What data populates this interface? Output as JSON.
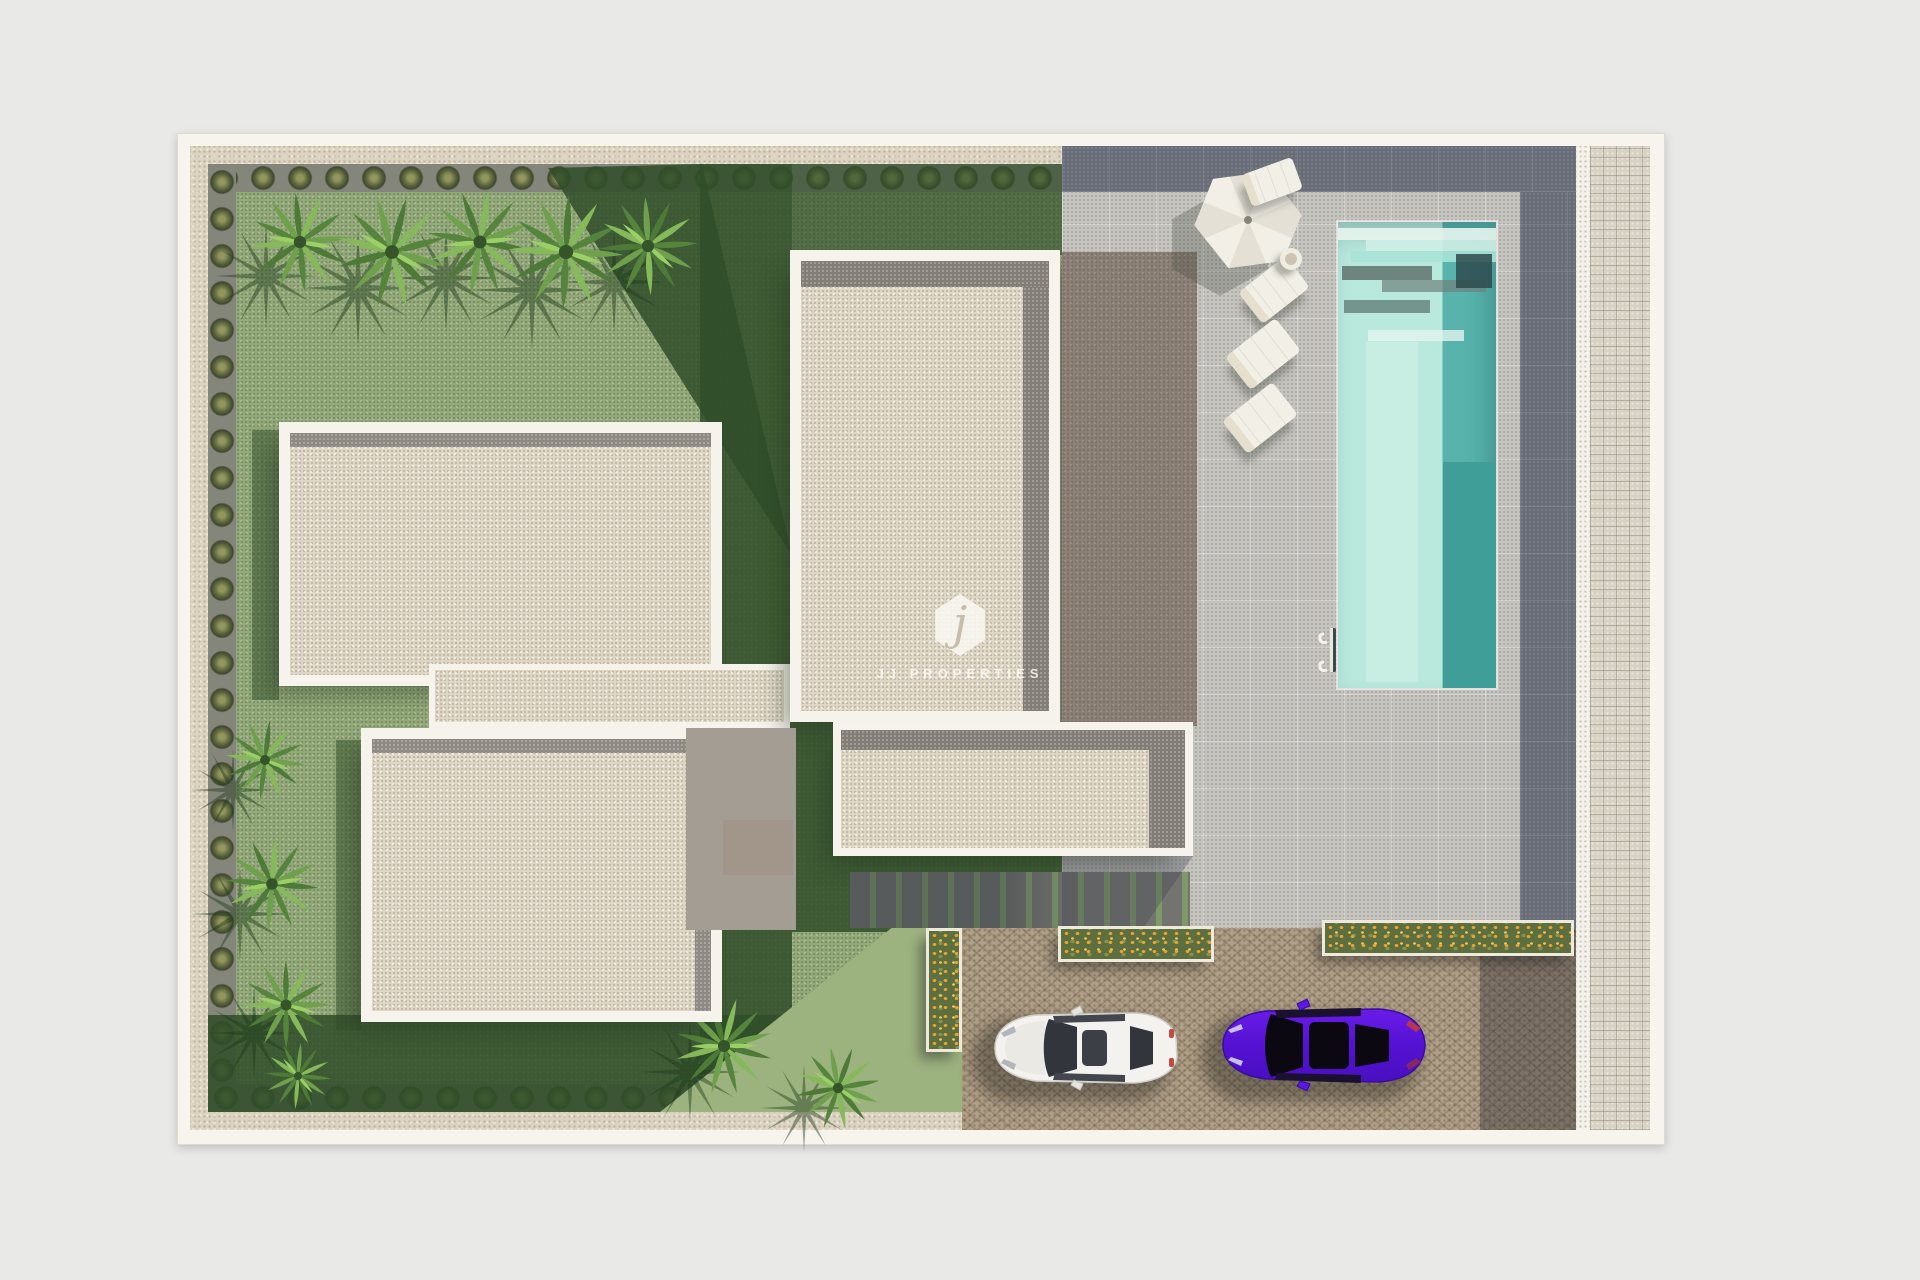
{
  "watermark": {
    "logo_letter": "j",
    "brand": "JJ PROPERTIES"
  },
  "scene": {
    "description": "Top-down 3D architectural render of a villa plot",
    "elements": [
      "garden lawn",
      "palm trees",
      "perimeter hedge",
      "villa flat roofs",
      "swimming pool",
      "pool ladder",
      "sun umbrella",
      "sun loungers",
      "side table",
      "flower planters",
      "stepping-stone path",
      "concrete terrace",
      "cobblestone driveway",
      "pavement sidewalk",
      "white car",
      "purple car"
    ],
    "counts": {
      "roof_volumes": 4,
      "sun_loungers": 4,
      "cars": 2,
      "flower_planters": 3,
      "palm_clusters_top": 5,
      "plants_left_border": 4,
      "palms_bottom": 2
    },
    "cars": [
      {
        "name": "white-car",
        "color": "#f3f2ef"
      },
      {
        "name": "purple-car",
        "color": "#5a13d6"
      }
    ]
  },
  "colors": {
    "page_bg": "#e9e9e8",
    "plan_border": "#f7f4ee",
    "gravel": "#dcd4c1",
    "grass": "#94a97b",
    "grass_shadow": "#2f4e29",
    "roof_fill": "#ded7c6",
    "roof_band": "#8e8983",
    "terrace": "#c6c4bf",
    "terrace_band": "#696d78",
    "upper_deck": "#8c8176",
    "pool_water_light": "#b9e9dd",
    "pool_water_dark": "#3f9e98",
    "driveway": "#b1a088",
    "sidewalk": "#d8d2c4",
    "flowers": "#eea32b",
    "hedge": "#636c42"
  }
}
